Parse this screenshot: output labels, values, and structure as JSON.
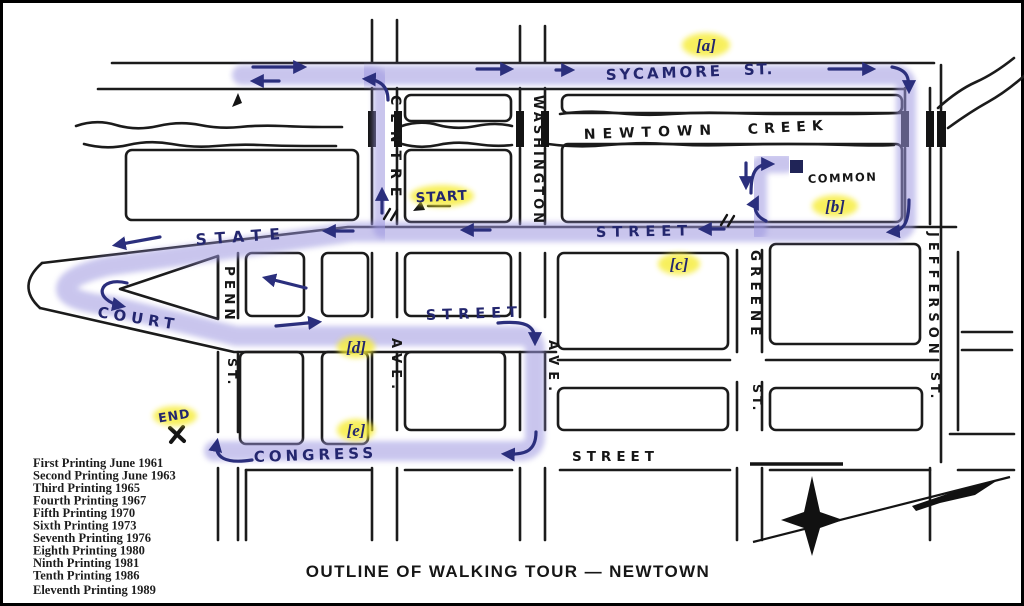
{
  "map": {
    "title": "OUTLINE OF WALKING TOUR — NEWTOWN",
    "colors": {
      "paper": "#ffffff",
      "ink": "#1b1b1b",
      "route_highlight": "#9d97e0",
      "route_ink": "#2b2f7d",
      "label_highlight": "#f6ec35"
    },
    "streets": {
      "sycamore": "SYCAMORE",
      "sycamore_suffix": "ST.",
      "newtown": "NEWTOWN",
      "creek": "CREEK",
      "state": "STATE",
      "state_suffix": "STREET",
      "court": "COURT",
      "court_suffix": "STREET",
      "congress": "CONGRESS",
      "congress_suffix": "STREET",
      "centre": "CENTRE",
      "centre_suffix": "AVE.",
      "washington": "WASHINGTON",
      "washington_suffix": "AVE.",
      "penn": "PENN",
      "penn_suffix": "ST.",
      "greene": "GREENE",
      "greene_suffix": "ST.",
      "jefferson": "JEFFERSON",
      "jefferson_suffix": "ST.",
      "common": "COMMON"
    },
    "tour": {
      "a": "[a]",
      "b": "[b]",
      "c": "[c]",
      "d": "[d]",
      "e": "[e]",
      "start": "START",
      "end": "END"
    },
    "printings": [
      "First Printing June 1961",
      "Second Printing June 1963",
      "Third Printing 1965",
      "Fourth Printing 1967",
      "Fifth Printing 1970",
      "Sixth Printing 1973",
      "Seventh Printing 1976",
      "Eighth Printing 1980",
      "Ninth Printing 1981",
      "Tenth Printing 1986",
      "Eleventh Printing 1989"
    ]
  }
}
